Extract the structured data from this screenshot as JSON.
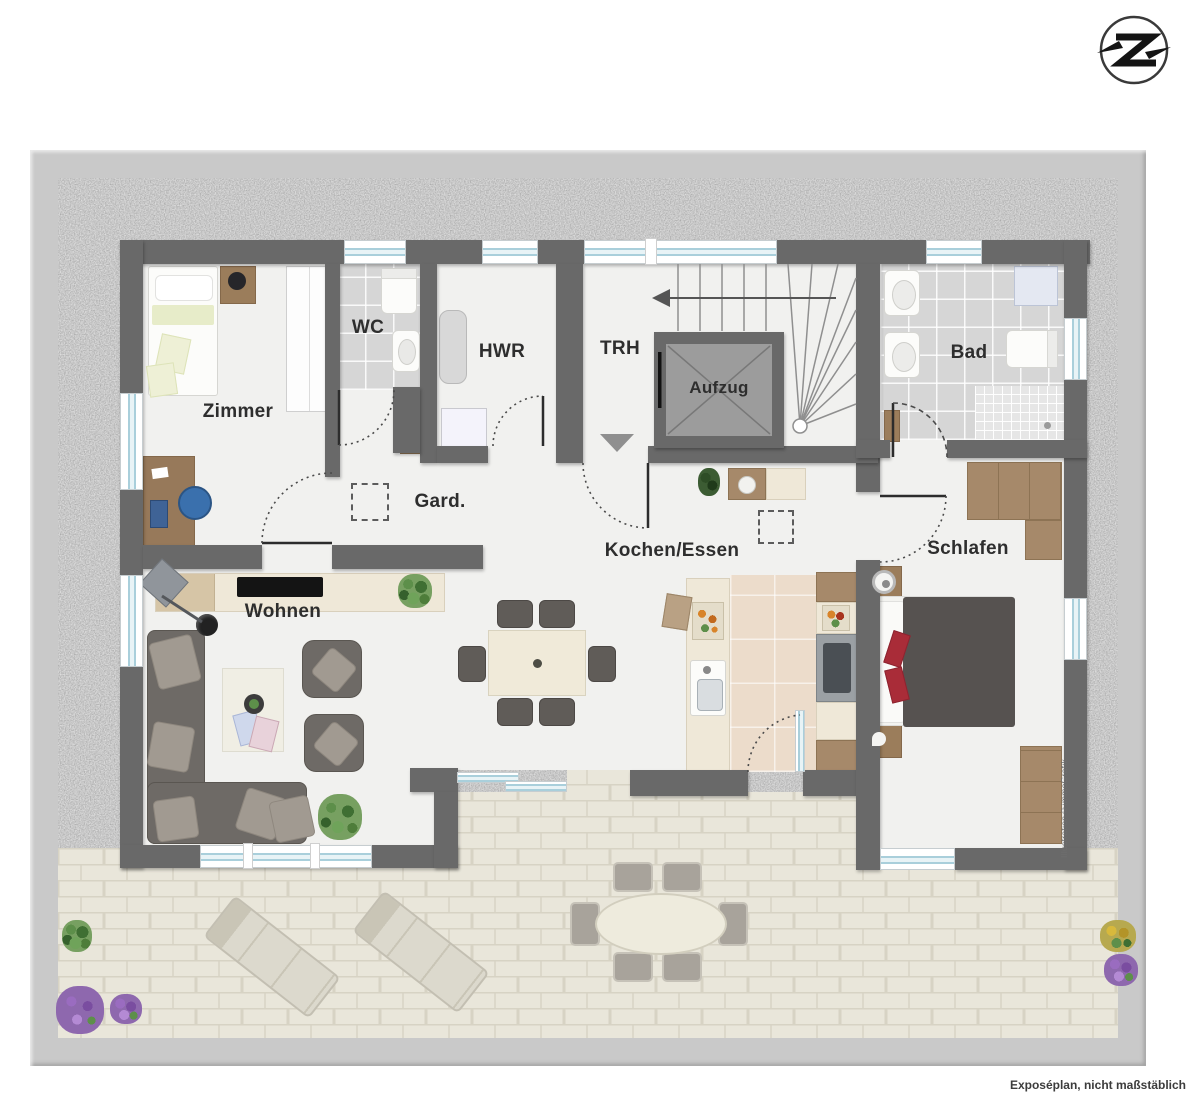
{
  "rooms": {
    "zimmer": {
      "label": "Zimmer"
    },
    "wc": {
      "label": "WC"
    },
    "hwr": {
      "label": "HWR"
    },
    "trh": {
      "label": "TRH"
    },
    "aufzug": {
      "label": "Aufzug"
    },
    "bad": {
      "label": "Bad"
    },
    "gard": {
      "label": "Gard."
    },
    "kochen": {
      "label": "Kochen/Essen"
    },
    "schlafen": {
      "label": "Schlafen"
    },
    "wohnen": {
      "label": "Wohnen"
    }
  },
  "footer": {
    "caption": "Exposéplan, nicht maßstäblich"
  },
  "watermark": "Illustration©immoGrafik",
  "logo": {
    "letter": "Z"
  },
  "colors": {
    "wall": "#696969",
    "frame": "#c9c9c9",
    "gravel": "#9b9b9b",
    "floor": "#f1f1ef",
    "wet_tile": "#d6d6d6",
    "kitchen_tile": "#ecdccb",
    "pavement": "#e9e6da",
    "window_glass": "#a9cfdb",
    "sofa": "#6e6a66",
    "wood": "#9b7d5b",
    "bed_duvet": "#565250",
    "accent_red": "#a92c38"
  }
}
